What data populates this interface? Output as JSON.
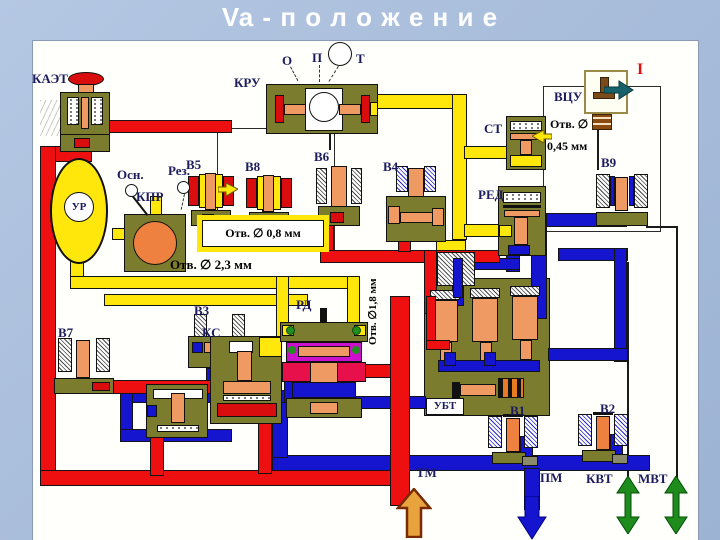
{
  "title": "Va - п о л о ж е н и е",
  "colors": {
    "background": "#a9bedb",
    "canvas": "#fffffb",
    "pipe_red": "#ee1010",
    "pipe_yellow": "#ffe70c",
    "pipe_blue": "#1515cf",
    "valve_body_olive": "#7c7c2e",
    "piston_salmon": "#ef9a62",
    "regulator_magenta": "#cc10cc",
    "regulator_crimson": "#e8104a",
    "arrow_green": "#1d8c1d",
    "arrow_teal": "#17616b",
    "arrow_brown": "#d98e2b",
    "label_navy": "#1b1b5e"
  },
  "components": {
    "kaet": "КАЭТ",
    "kru": "КРУ",
    "vcu": "ВЦУ",
    "st": "СТ",
    "red": "РЕД",
    "v9": "В9",
    "ur": "УР",
    "osn": "Осн.",
    "rez": "Рез.",
    "kpr": "КПР",
    "v5": "В5",
    "v8": "В8",
    "v6": "В6",
    "v4": "В4",
    "v7": "В7",
    "ks": "КС",
    "v3": "В3",
    "rd": "РД",
    "ubt": "УБТ",
    "v1": "В1",
    "v2": "В2"
  },
  "ports": {
    "o": "О",
    "p": "П",
    "t": "Т",
    "i": "I",
    "tm": "ТМ",
    "pm": "ПМ",
    "kvt": "КВТ",
    "mvt": "МВТ"
  },
  "annotations": {
    "otv045_line1": "Отв. ∅",
    "otv045_line2": "0,45 мм",
    "otv08": "Отв. ∅ 0,8 мм",
    "otv23": "Отв. ∅ 2,3 мм",
    "otv18": "Отв. ∅1,8 мм"
  }
}
